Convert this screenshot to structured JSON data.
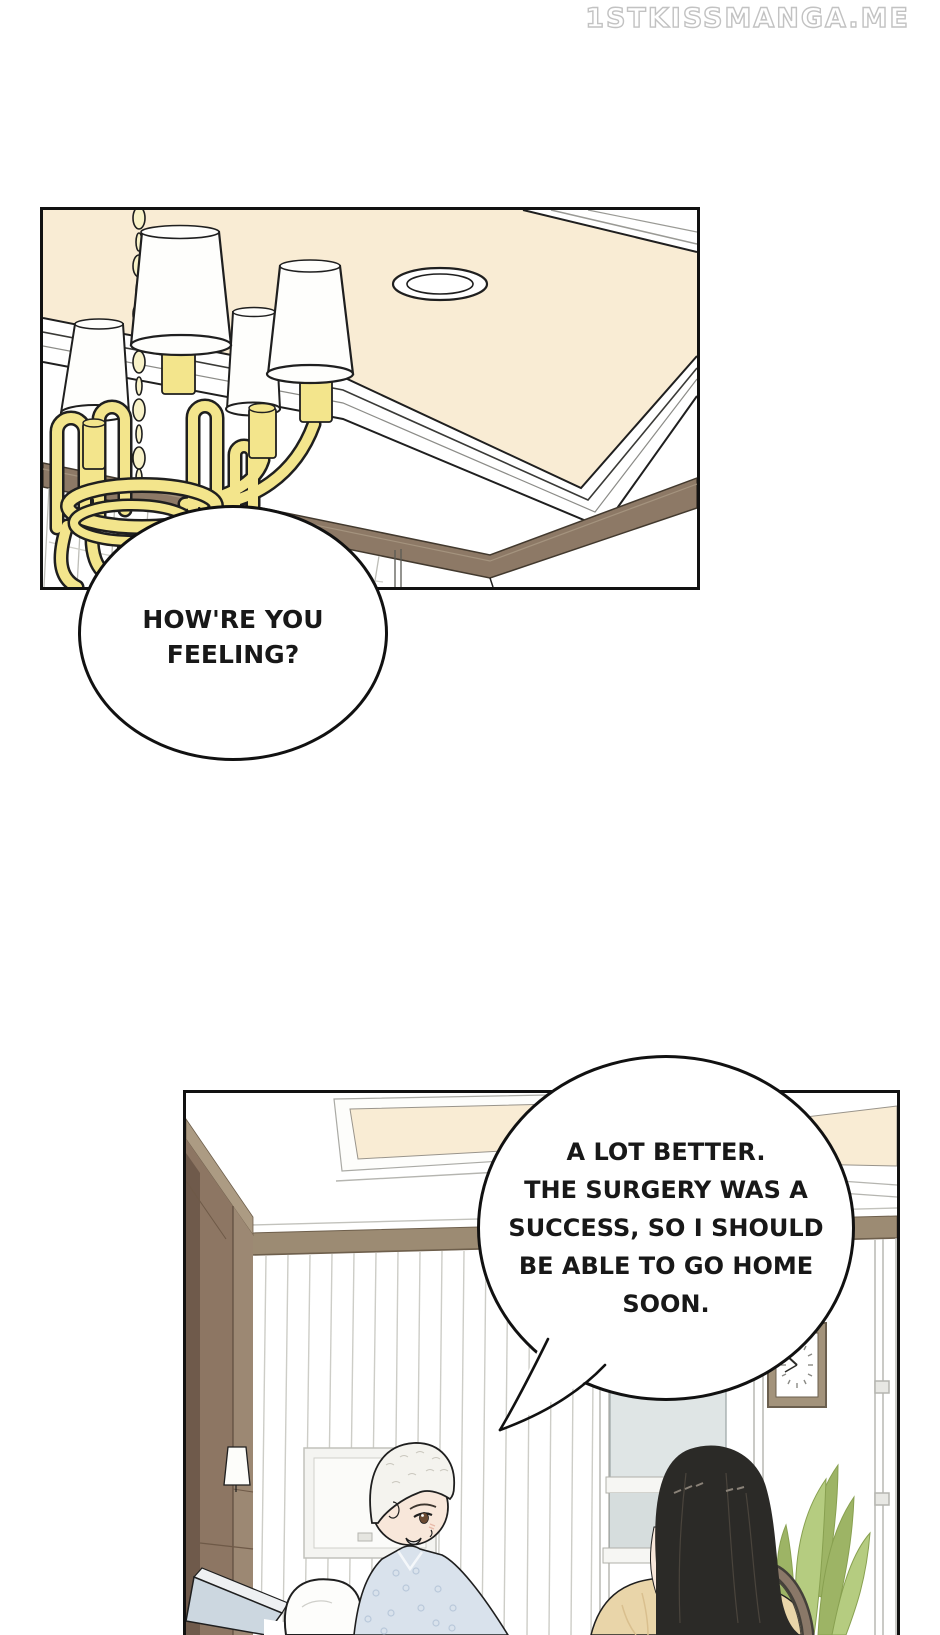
{
  "watermark": {
    "text": "1STKISSMANGA.ME"
  },
  "bubbles": {
    "bubble1": {
      "speaker": "off-panel",
      "lines": [
        "HOW'RE YOU",
        "FEELING?"
      ]
    },
    "bubble2": {
      "speaker": "patient",
      "lines": [
        "A LOT BETTER.",
        "THE SURGERY WAS A",
        "SUCCESS, SO I SHOULD",
        "BE ABLE TO GO HOME",
        "SOON."
      ]
    }
  },
  "scene_objects": {
    "panel1": "hotel ceiling corner with chandelier and recessed light",
    "panel2": "hospital room with patient in bed and visitor",
    "clock_time_appearance": "hands pointing left"
  },
  "colors": {
    "ink": "#1f1f1f",
    "cream": "#f9ecd4",
    "lamp_yellow": "#f3e58c",
    "chain_gold": "#f8f2c8",
    "molding_brown": "#8d7966",
    "rail_brown": "#9c8b73",
    "cabinet_brown": "#8d7663",
    "cabinet_dark": "#6f5a4b",
    "cabinet_light": "#9c8873",
    "cornice_tan": "#ac9b83",
    "glass_blue": "#dfe5e5",
    "gown_blue": "#d9e2ec",
    "gown_pattern": "#b9c8da",
    "bed_blue": "#ccd7e0",
    "skin": "#f8e7da",
    "hair_black": "#2b2a27",
    "coat_beige": "#e9d5a9",
    "coat_shade": "#d9bf8e",
    "bag_brown": "#8a7868",
    "plant_green": "#b5cc80",
    "plant_dark": "#9db465",
    "clock_frame": "#a3937b",
    "line_gray": "#bdbdb7",
    "curtain_gray": "#cdcdc7",
    "watermark_outline": "#c2c2c2"
  }
}
